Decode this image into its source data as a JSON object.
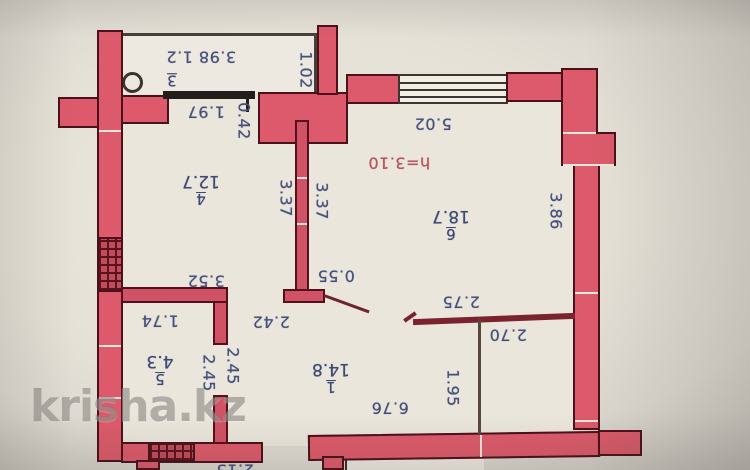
{
  "watermark": {
    "text": "krisha.kz"
  },
  "plan": {
    "ceiling_height_note": "h=3.10",
    "colors": {
      "wall_fill": "#dc5a6b",
      "wall_outline": "#4a1118",
      "dimension_ink": "#46517b",
      "height_note_ink": "#b5535f",
      "paper": "#ebe6dc"
    },
    "rooms": {
      "r1": {
        "number": "1",
        "area": "14.8"
      },
      "r3": {
        "number": "3"
      },
      "r4": {
        "number": "4",
        "area": "12.7"
      },
      "r5": {
        "number": "5",
        "area": "4.3"
      },
      "r6": {
        "number": "6",
        "area": "18.7"
      }
    },
    "dims": {
      "balcony_size": "3.98 1.2",
      "balcony_depth": "1.02",
      "balcony_door": "1.97",
      "wall_piece_042": "0.42",
      "room4_left_337": "3.37",
      "room4_right_337": "3.37",
      "room6_width": "5.02",
      "ceiling_height": "h=3.10",
      "room6_depth": "3.86",
      "door_stub_055": "0.55",
      "room4_width": "3.52",
      "room5_width": "1.74",
      "hall_width": "2.42",
      "room5_depth_a": "2.45",
      "room5_depth_b": "2.45",
      "bath_width": "2.75",
      "bath_width_inner": "2.70",
      "bath_depth": "1.95",
      "hall_length": "6.76",
      "bottom_partial": "2.13"
    }
  }
}
